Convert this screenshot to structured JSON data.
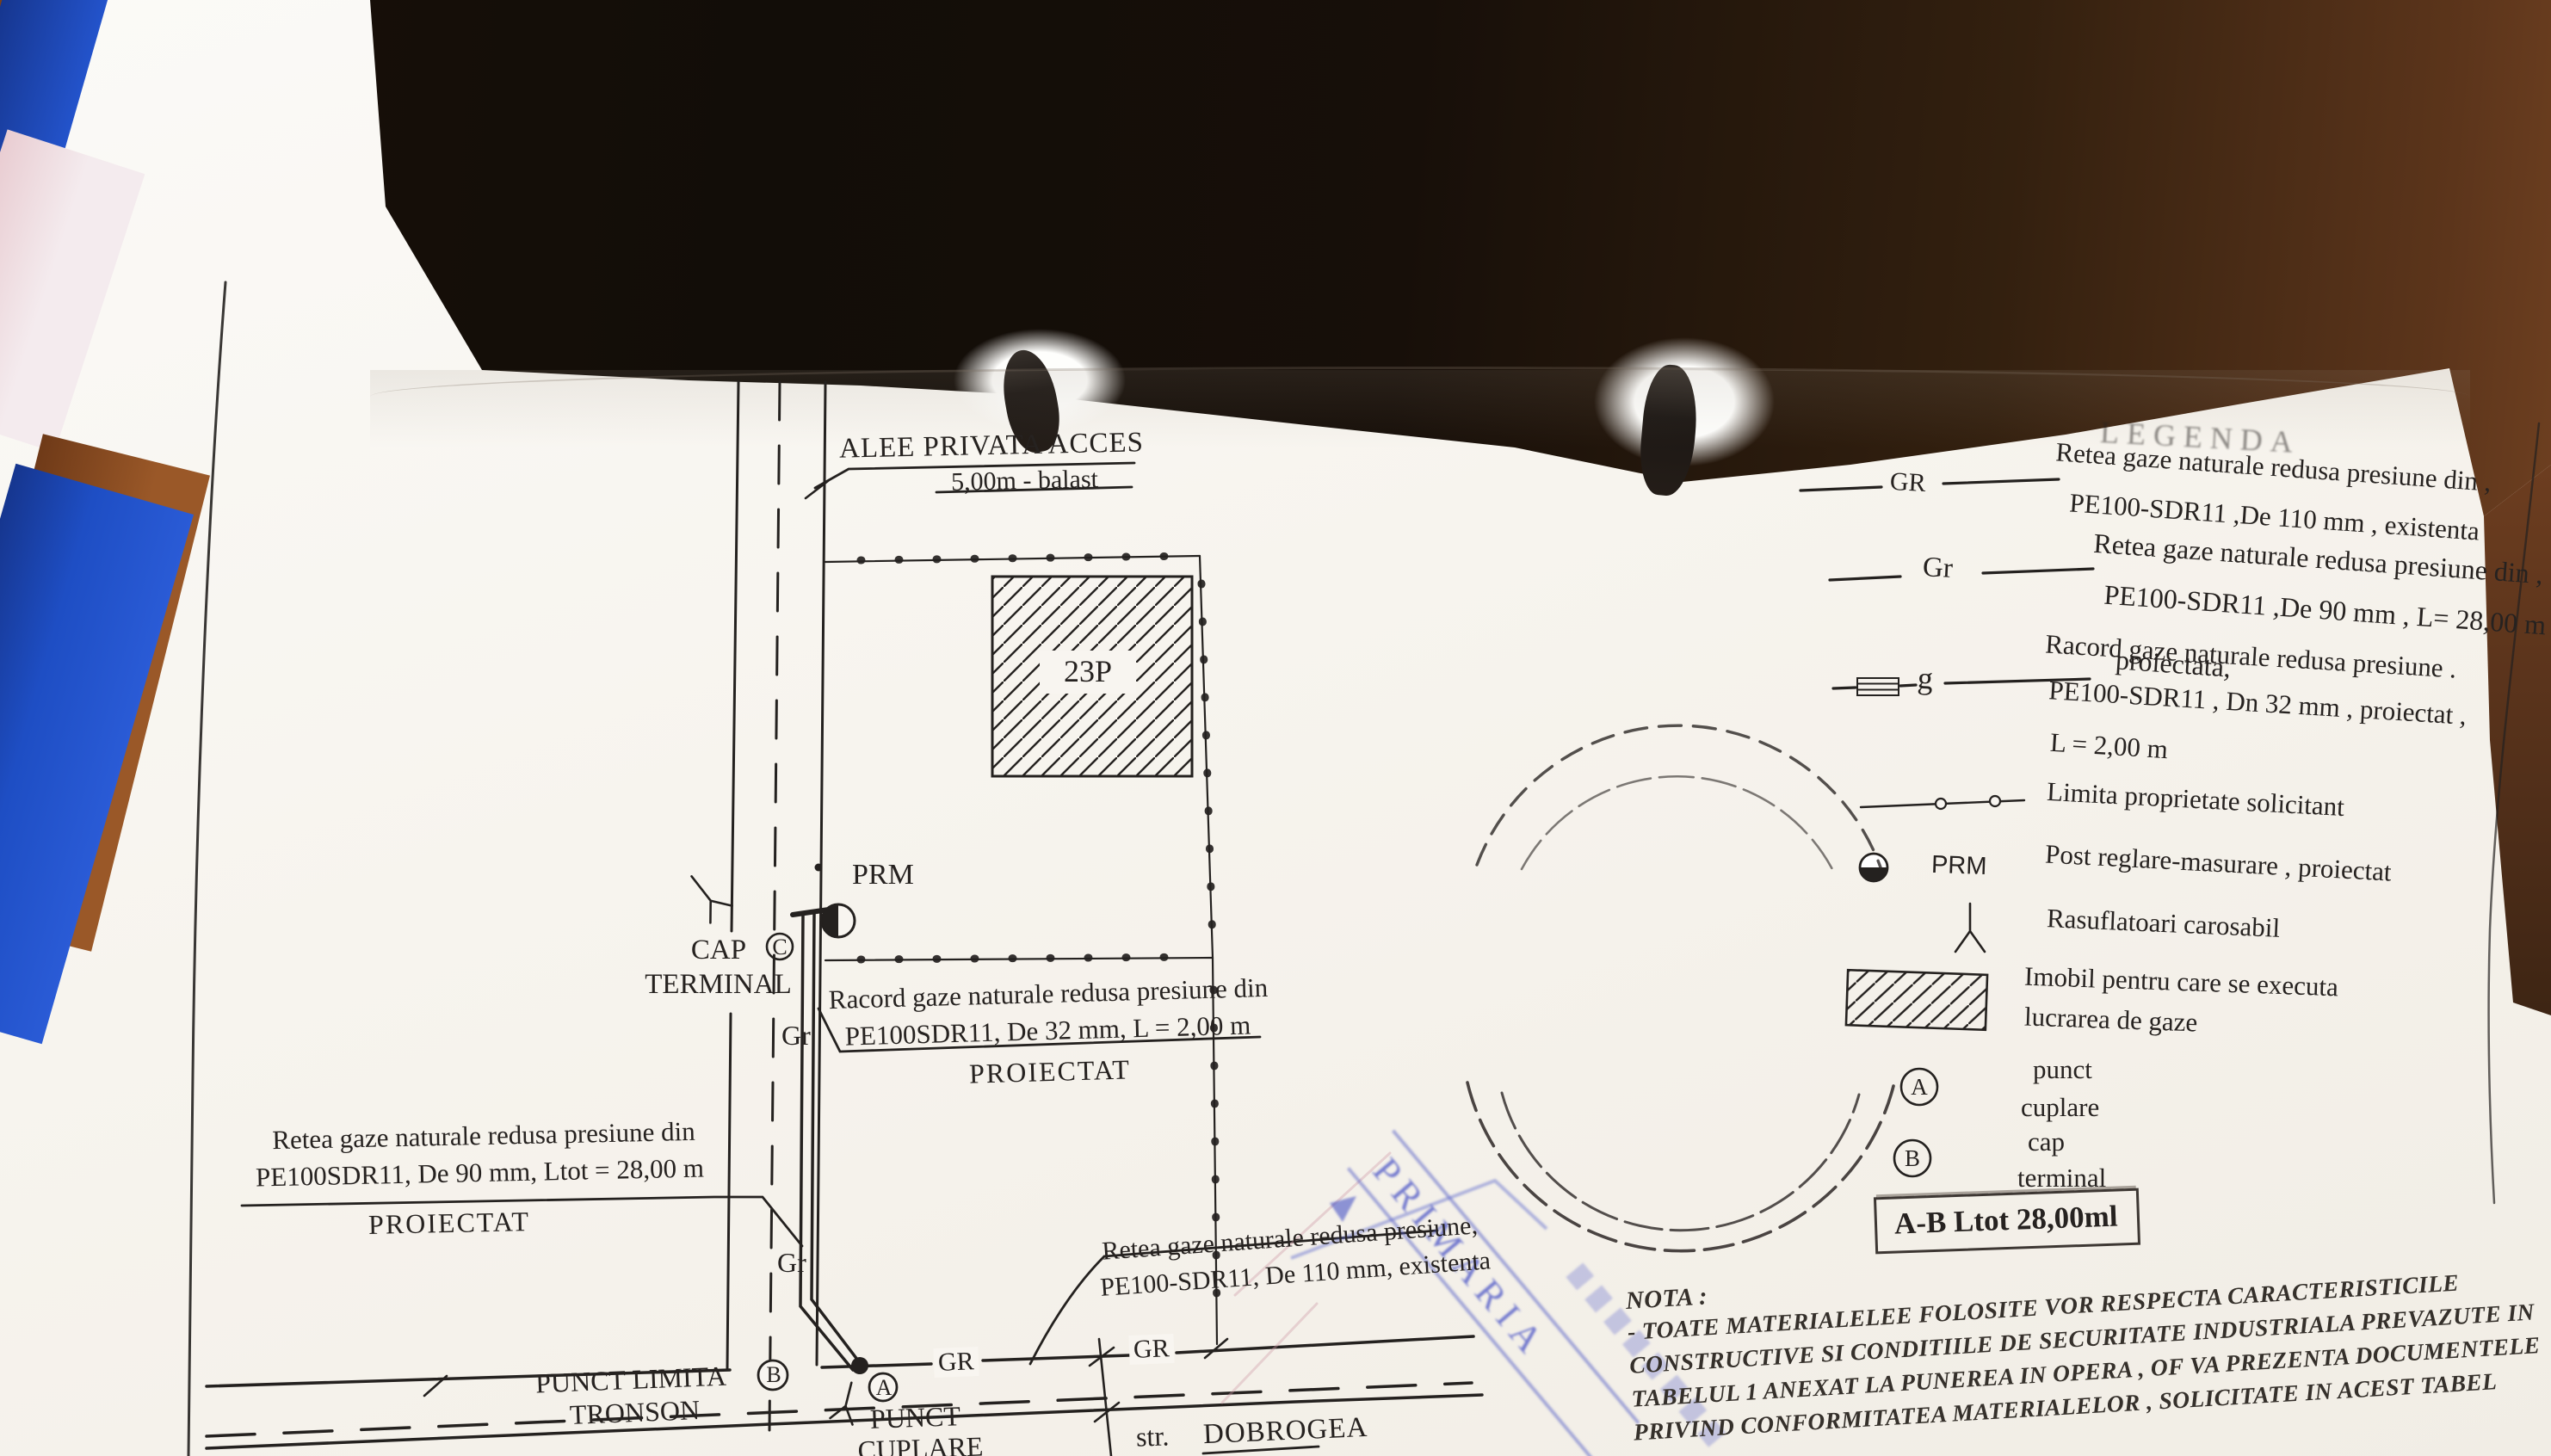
{
  "plan": {
    "alley": {
      "line1": "ALEE PRIVATA ACCES",
      "line2": "5,00m - balast"
    },
    "building_label": "23P",
    "prm_label": "PRM",
    "cap_terminal": {
      "line1": "CAP",
      "line2": "TERMINAL",
      "marker": "C"
    },
    "riser_labels": {
      "upper": "Gr",
      "lower": "Gr"
    },
    "racord_note": {
      "line1": "Racord gaze naturale redusa presiune din",
      "line2": "PE100SDR11, De 32 mm, L = 2,00 m",
      "line3": "PROIECTAT"
    },
    "retea_proiectata_note": {
      "line1": "Retea gaze naturale redusa presiune din",
      "line2": "PE100SDR11, De 90 mm, Ltot = 28,00 m",
      "line3": "PROIECTAT"
    },
    "retea_existenta_note": {
      "line1": "Retea gaze naturale redusa presiune,",
      "line2": "PE100-SDR11, De 110 mm, existenta"
    },
    "punct_limita": {
      "line1": "PUNCT LIMITA",
      "line2": "TRONSON"
    },
    "punct_cuplare": {
      "line1": "PUNCT",
      "line2": "CUPLARE"
    },
    "marker_a": "A",
    "marker_b": "B",
    "gas_labels": {
      "first": "GR",
      "second": "GR"
    },
    "street": {
      "prefix": "str.",
      "name": "DOBROGEA"
    }
  },
  "legend": {
    "title": "LEGENDA",
    "entries": [
      {
        "symbol": "existing-gas-line",
        "label": "GR",
        "lines": [
          "Retea  gaze naturale redusa presiune din ,",
          "PE100-SDR11 ,De 110 mm ,  existenta"
        ]
      },
      {
        "symbol": "projected-gas-line",
        "label": "Gr",
        "lines": [
          "Retea  gaze naturale redusa presiune din ,",
          "PE100-SDR11 ,De 90 mm , L= 28,00 m ,",
          "proiectata,"
        ]
      },
      {
        "symbol": "service-connection",
        "label": "g",
        "lines": [
          "Racord  gaze naturale redusa presiune .",
          "PE100-SDR11 , Dn 32 mm ,  proiectat ,",
          "L = 2,00 m"
        ]
      },
      {
        "symbol": "property-limit",
        "label": "",
        "lines": [
          "Limita proprietate solicitant"
        ]
      },
      {
        "symbol": "prm",
        "label": "PRM",
        "lines": [
          "Post reglare-masurare  , proiectat"
        ]
      },
      {
        "symbol": "vent",
        "label": "",
        "lines": [
          "Rasuflatoari carosabil"
        ]
      },
      {
        "symbol": "building-hatch",
        "label": "",
        "lines": [
          "Imobil pentru care se executa",
          "lucrarea de gaze"
        ]
      },
      {
        "symbol": "point-a",
        "label": "A",
        "lines": [
          "punct",
          "cuplare"
        ]
      },
      {
        "symbol": "point-b",
        "label": "B",
        "lines": [
          "cap",
          "terminal"
        ]
      }
    ],
    "summary": "A-B   Ltot 28,00ml"
  },
  "nota": {
    "title": "NOTA :",
    "lines": [
      "- TOATE MATERIALELEE FOLOSITE VOR RESPECTA CARACTERISTICILE",
      "CONSTRUCTIVE SI CONDITIILE DE SECURITATE INDUSTRIALA PREVAZUTE IN",
      "TABELUL 1 ANEXAT   LA PUNEREA IN OPERA , OF VA PREZENTA DOCUMENTELE",
      "PRIVIND CONFORMITATEA MATERIALELOR , SOLICITATE IN ACEST TABEL"
    ]
  },
  "stamp": {
    "text": "PRIMARIA"
  }
}
